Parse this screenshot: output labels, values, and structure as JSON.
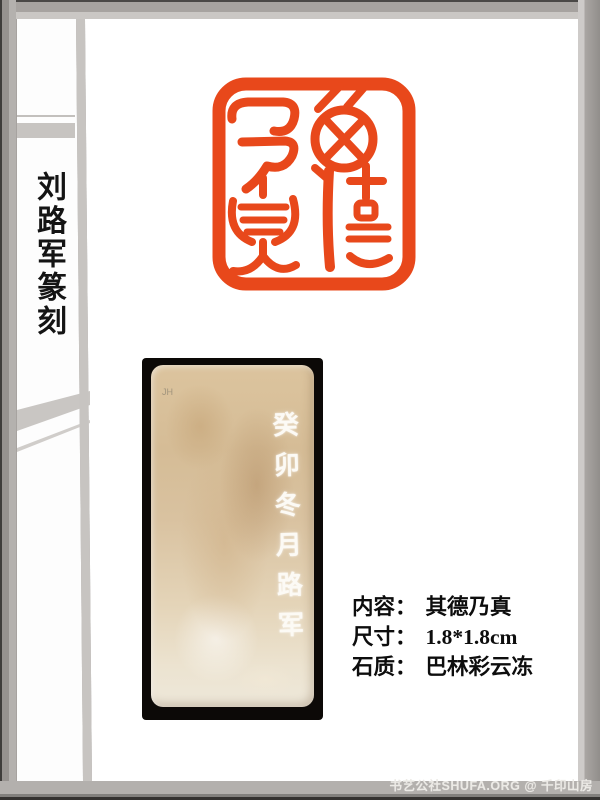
{
  "page": {
    "spine_title": "刘路军篆刻",
    "watermark": "书艺公社SHUFA.ORG @ 千印山房",
    "frame_color": "#a7a3a0"
  },
  "seal": {
    "characters": "其德乃真",
    "color": "#e8481b"
  },
  "stone": {
    "photo_bg": "#0c0907",
    "base_color": "#d8bf9b",
    "corner_mark": "JH",
    "side_inscription": "癸卯冬月路军"
  },
  "info": {
    "rows": [
      {
        "label": "内容：",
        "value": "其德乃真"
      },
      {
        "label": "尺寸：",
        "value": "1.8*1.8cm"
      },
      {
        "label": "石质：",
        "value": "巴林彩云冻"
      }
    ]
  }
}
